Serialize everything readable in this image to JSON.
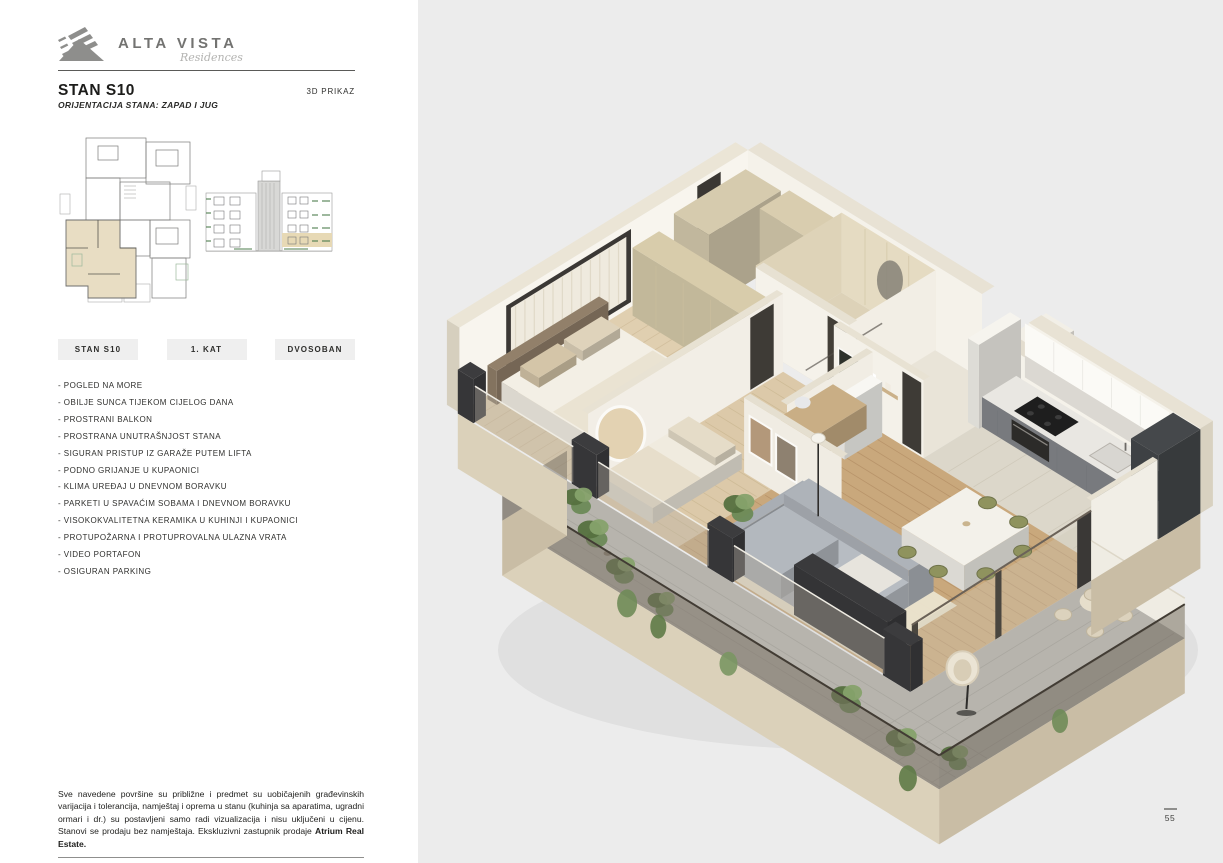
{
  "brand": {
    "name": "ALTA VISTA",
    "tagline": "Residences"
  },
  "header": {
    "title": "STAN S10",
    "subtitle": "ORIJENTACIJA STANA: ZAPAD I JUG",
    "view_label": "3D PRIKAZ"
  },
  "badges": [
    {
      "label": "STAN S10"
    },
    {
      "label": "1. KAT"
    },
    {
      "label": "DVOSOBAN"
    }
  ],
  "features": [
    "POGLED NA MORE",
    "OBILJE SUNCA TIJEKOM CIJELOG DANA",
    "PROSTRANI BALKON",
    "PROSTRANA UNUTRAŠNJOST STANA",
    "SIGURAN PRISTUP IZ GARAŽE PUTEM LIFTA",
    "PODNO GRIJANJE U KUPAONICI",
    "KLIMA UREĐAJ U DNEVNOM BORAVKU",
    "PARKETI U SPAVAĆIM SOBAMA I DNEVNOM BORAVKU",
    "VISOKOKVALITETNA KERAMIKA U KUHINJI I KUPAONICI",
    "PROTUPOŽARNA I PROTUPROVALNA ULAZNA VRATA",
    "VIDEO PORTAFON",
    "OSIGURAN PARKING"
  ],
  "disclaimer": {
    "text": "Sve navedene površine su približne i predmet su uobičajenih građevinskih varijacija i tolerancija, namještaj i oprema u stanu (kuhinja sa aparatima, ugradni ormari i dr.) su postavljeni samo radi vizualizacija i nisu uključeni u cijenu. Stanovi se prodaju bez namještaja. Ekskluzivni zastupnik prodaje ",
    "agent": "Atrium Real Estate."
  },
  "page_number": "55",
  "colors": {
    "panel_bg": "#ececec",
    "left_bg": "#ffffff",
    "badge_bg": "#efefef",
    "text": "#2f2f2d",
    "unit_highlight": "#e8ddc3",
    "elevation_green": "#4e7d4e",
    "brand_gray": "#8e8e8c"
  }
}
